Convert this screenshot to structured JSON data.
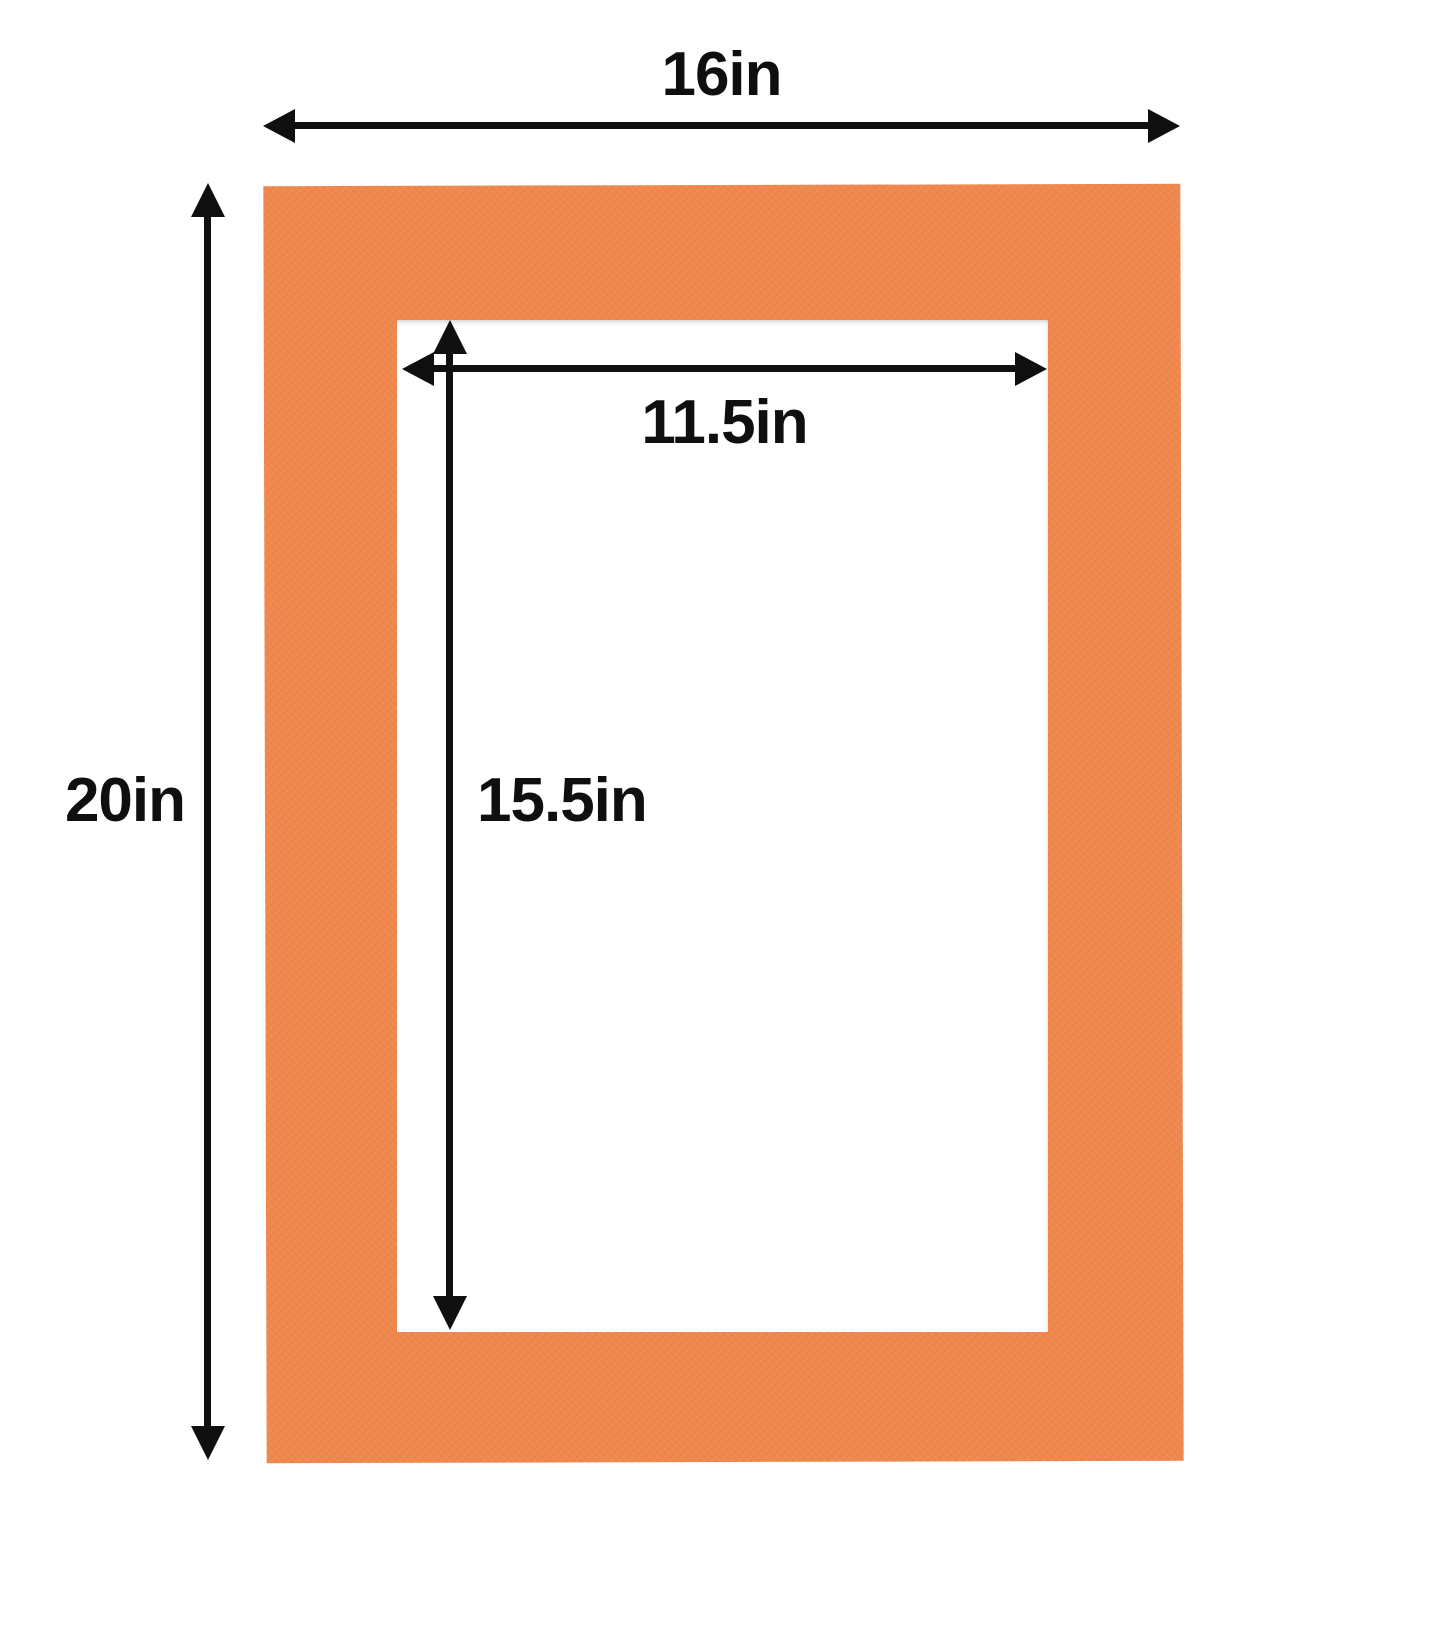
{
  "diagram": {
    "colors": {
      "background": "#ffffff",
      "mat": "#F0874C",
      "lines": "#0f0f0f"
    },
    "dimensions": {
      "outer_width": {
        "label": "16in",
        "value_in": 16
      },
      "outer_height": {
        "label": "20in",
        "value_in": 20
      },
      "opening_width": {
        "label": "11.5in",
        "value_in": 11.5
      },
      "opening_height": {
        "label": "15.5in",
        "value_in": 15.5
      }
    }
  }
}
